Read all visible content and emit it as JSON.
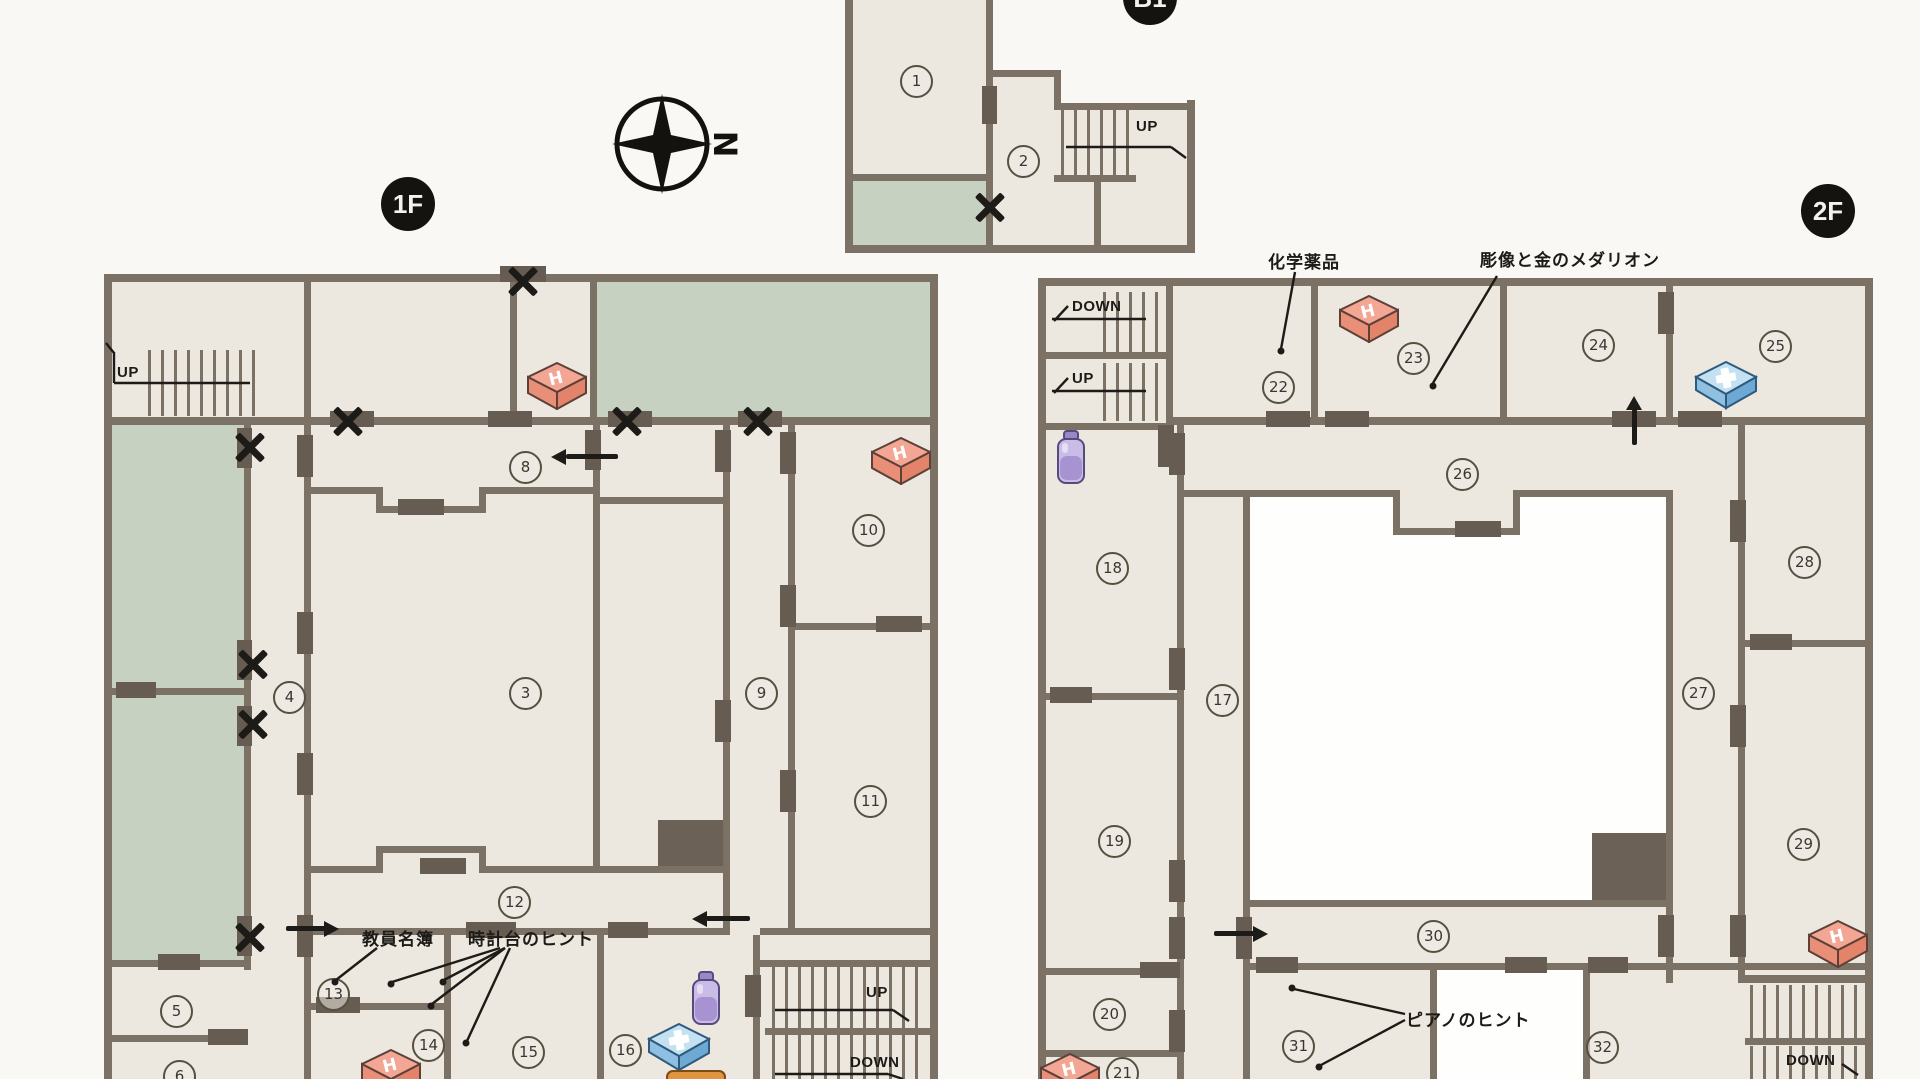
{
  "page": {
    "background": "#faf8f4",
    "floor_color": "#ece7df",
    "green_color": "#c6d1c2",
    "wall_color": "#7b7164",
    "courtyard_color": "#fefefc",
    "ink_color": "#1d1b18"
  },
  "badges": {
    "b1": "B1",
    "f1": "1F",
    "f2": "2F"
  },
  "compass": {
    "north_label": "N"
  },
  "stairs": {
    "up_label": "UP",
    "down_label": "DOWN"
  },
  "rooms": {
    "b1": [
      "1",
      "2"
    ],
    "f1": [
      "3",
      "4",
      "5",
      "6",
      "8",
      "9",
      "10",
      "11",
      "12",
      "13",
      "14",
      "15",
      "16"
    ],
    "f2": [
      "17",
      "18",
      "19",
      "20",
      "21",
      "22",
      "23",
      "24",
      "25",
      "26",
      "27",
      "28",
      "29",
      "30",
      "31",
      "32"
    ]
  },
  "annotations": {
    "chemicals": "化学薬品",
    "statue_and_gold_medallion": "彫像と金のメダリオン",
    "faculty_roster": "教員名簿",
    "clock_tower_hint": "時計台のヒント",
    "piano_hint": "ピアノのヒント"
  },
  "icons": {
    "h_box_letter": "H",
    "h_box_meaning": "item-box-H",
    "cross_box_meaning": "first-aid-kit",
    "jar_meaning": "medicine-bottle",
    "orange_item_meaning": "item-box-orange"
  }
}
